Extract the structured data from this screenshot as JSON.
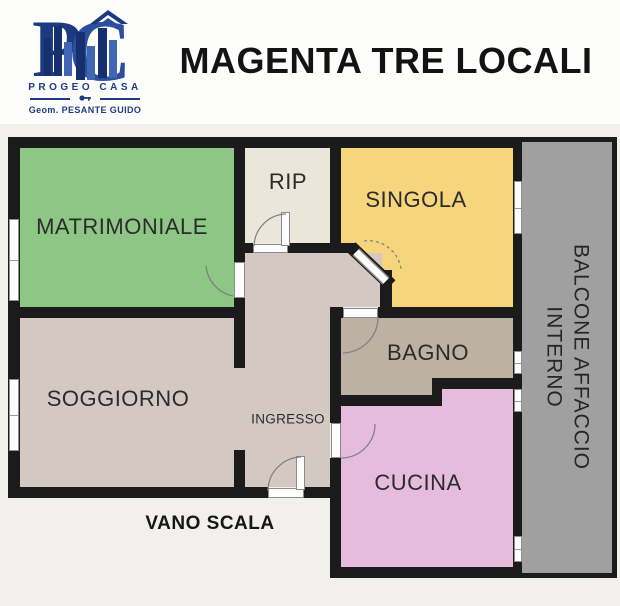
{
  "header": {
    "logo": {
      "monogram": "PC",
      "company": "PROGEO CASA",
      "tagline": "Geom. PESANTE GUIDO",
      "brand_color": "#1e3c86",
      "brand_color_light": "#2f57a8"
    },
    "title": "MAGENTA TRE LOCALI"
  },
  "floorplan": {
    "background": "#f2f0ec",
    "wall_color": "#1b1b1b",
    "door_window_color": "#fdfdfd",
    "arc_color": "#828282",
    "rooms": [
      {
        "id": "matrimoniale",
        "label": "MATRIMONIALE",
        "color": "#8ec686"
      },
      {
        "id": "rip",
        "label": "RIP",
        "color": "#ebe6da"
      },
      {
        "id": "singola",
        "label": "SINGOLA",
        "color": "#f6d57d"
      },
      {
        "id": "bagno",
        "label": "BAGNO",
        "color": "#bcb1a2"
      },
      {
        "id": "soggiorno",
        "label": "SOGGIORNO",
        "color": "#d3c9c2"
      },
      {
        "id": "ingresso",
        "label": "INGRESSO",
        "color": "#d3c9c2"
      },
      {
        "id": "cucina",
        "label": "CUCINA",
        "color": "#e5bcde"
      },
      {
        "id": "balcone",
        "label": "BALCONE AFFACCIO\nINTERNO",
        "color": "#a1a0a0"
      }
    ],
    "outside_label": "VANO SCALA"
  }
}
